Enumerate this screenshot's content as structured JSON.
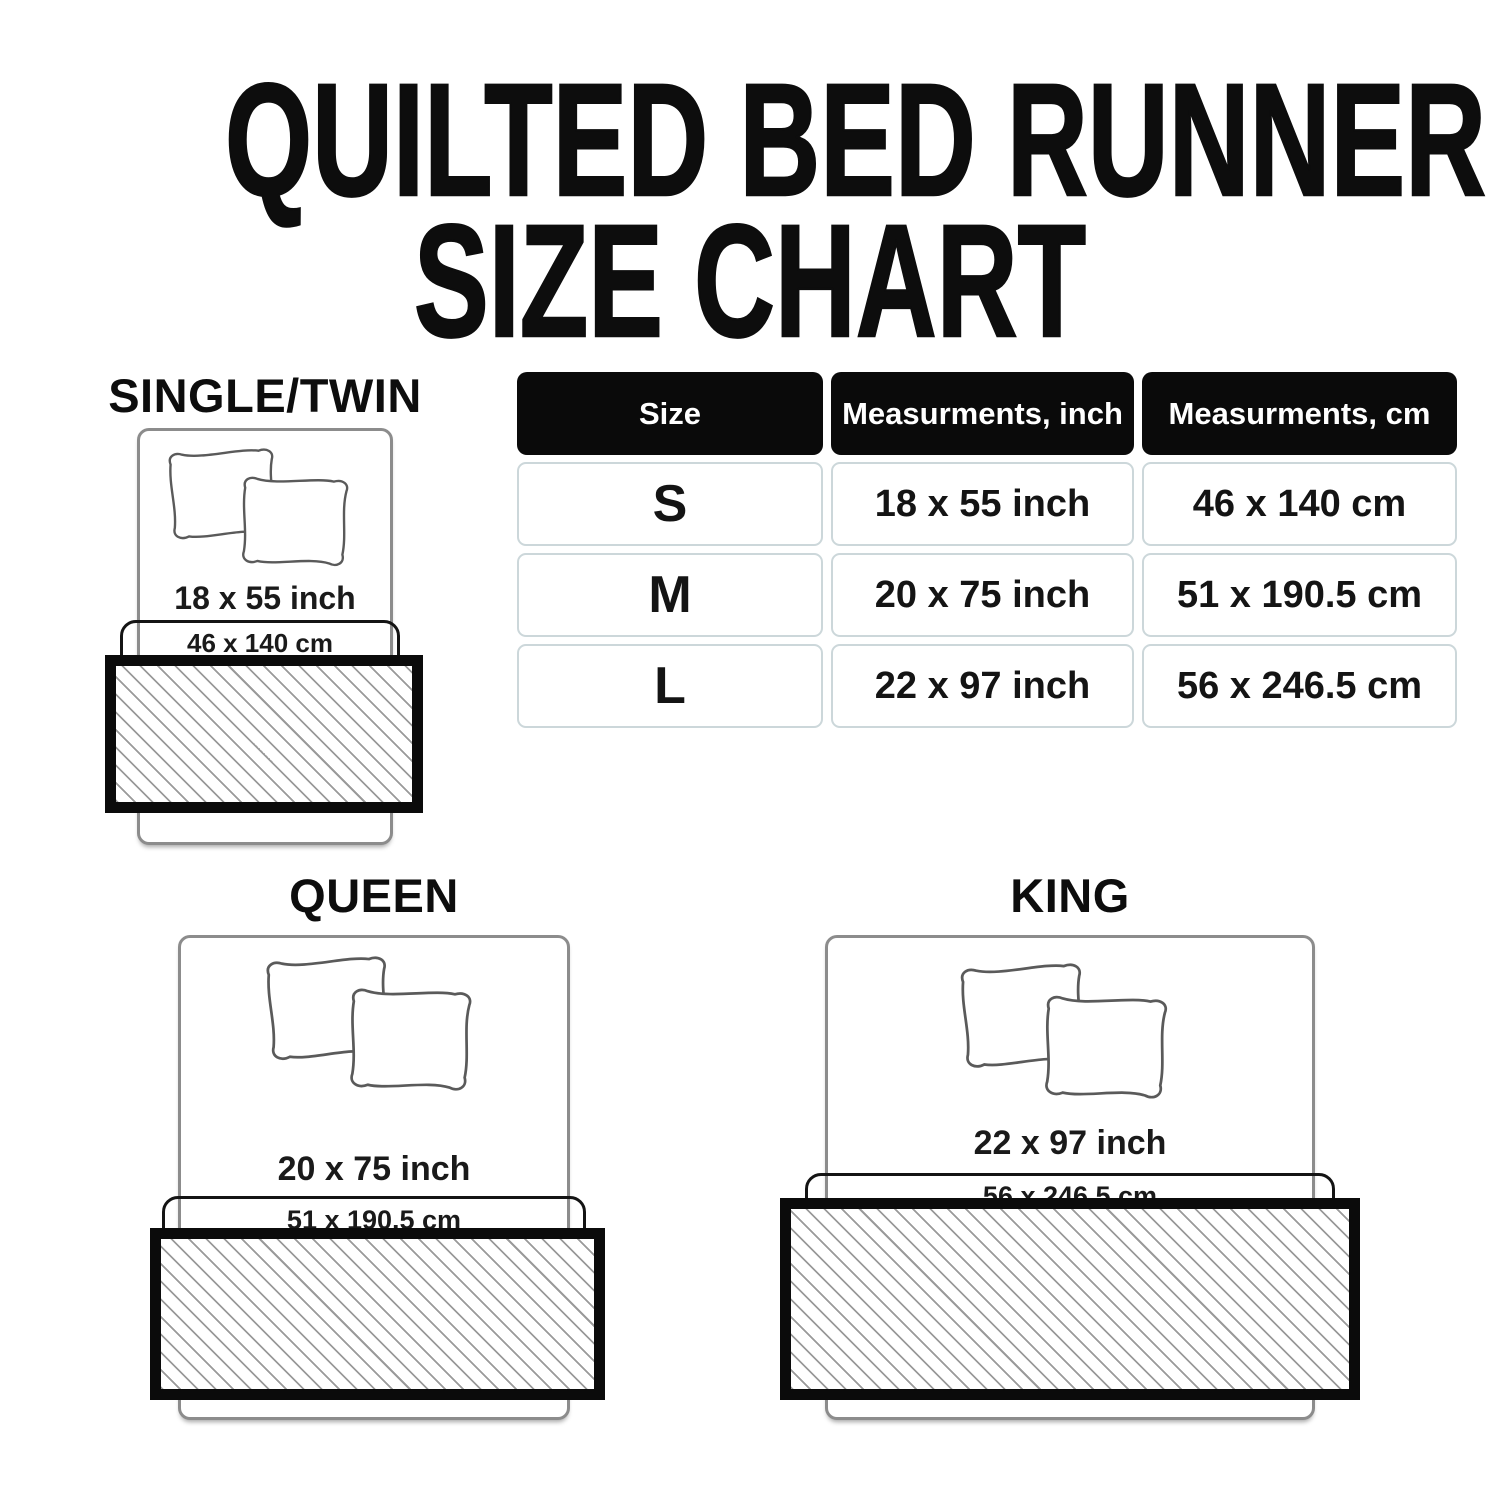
{
  "page_title": {
    "line1": "QUILTED BED RUNNER",
    "line2": "SIZE CHART"
  },
  "size_table": {
    "headers": [
      "Size",
      "Measurments, inch",
      "Measurments, cm"
    ],
    "rows": [
      {
        "size": "S",
        "inch": "18 x 55 inch",
        "cm": "46 x 140 cm"
      },
      {
        "size": "M",
        "inch": "20 x 75 inch",
        "cm": "51 x 190.5 cm"
      },
      {
        "size": "L",
        "inch": "22 x 97 inch",
        "cm": "56 x 246.5 cm"
      }
    ]
  },
  "diagrams": [
    {
      "label": "SINGLE/TWIN",
      "inch": "18 x 55 inch",
      "cm": "46 x 140 cm"
    },
    {
      "label": "QUEEN",
      "inch": "20 x 75 inch",
      "cm": "51 x 190.5 cm"
    },
    {
      "label": "KING",
      "inch": "22 x 97 inch",
      "cm": "56 x 246.5 cm"
    }
  ],
  "colors": {
    "text": "#141414",
    "header_bg": "#0a0a0a",
    "header_text": "#ffffff",
    "cell_border": "#ccd7da",
    "bed_outline": "#8c8c8c",
    "runner_border": "#0b0b0b",
    "hatch_line": "#9a9a9a"
  }
}
